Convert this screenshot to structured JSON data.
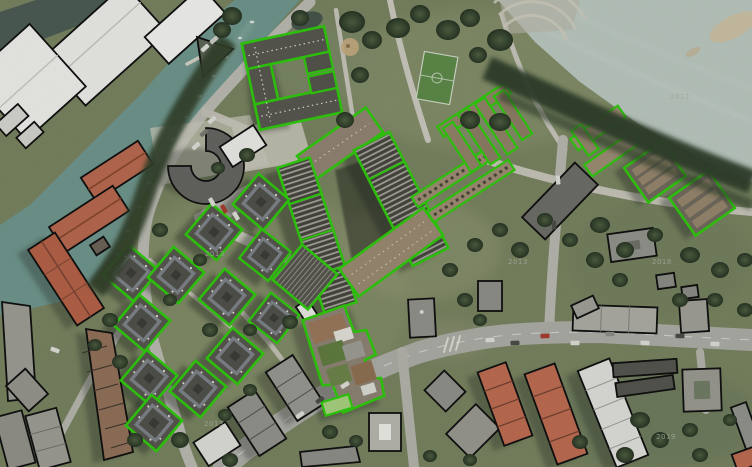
{
  "palette": {
    "detected": "#2fc60d",
    "reference": "#101010",
    "waterChannel": "#6d938a",
    "waterRiver": "#b6c3bb",
    "grass": "#76815f",
    "road": "#afafa7",
    "redRoof": "#b5684f",
    "darkRoof": "#55554d",
    "brownRoof": "#8f8171",
    "tree": "#31402b"
  },
  "map_labels": [
    {
      "text": "2012",
      "x": 670,
      "y": 99
    },
    {
      "text": "2013",
      "x": 508,
      "y": 264
    },
    {
      "text": "2018",
      "x": 652,
      "y": 264
    },
    {
      "text": "2013",
      "x": 205,
      "y": 256
    },
    {
      "text": "2013",
      "x": 204,
      "y": 426
    },
    {
      "text": "2019",
      "x": 656,
      "y": 439
    }
  ]
}
